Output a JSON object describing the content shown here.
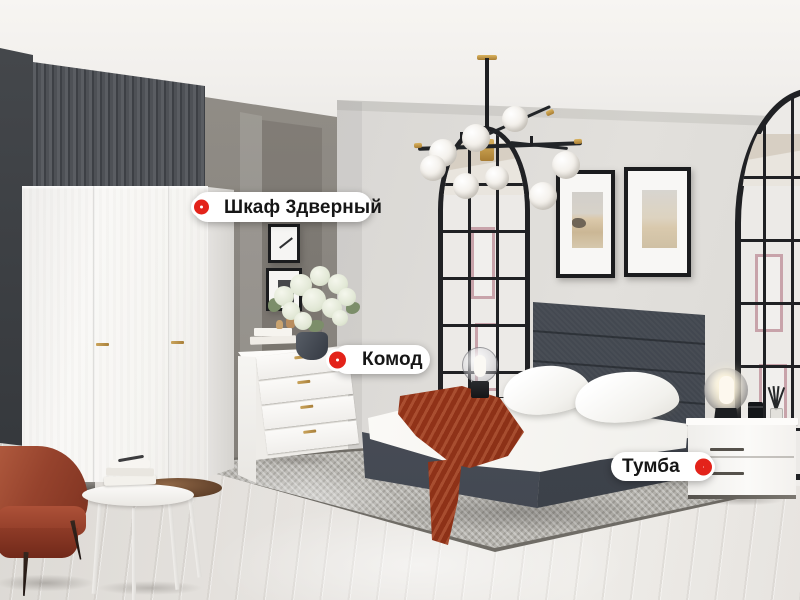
{
  "hotspots": [
    {
      "id": "wardrobe",
      "label": "Шкаф 3дверный",
      "marker": "red-ring-icon",
      "marker_side": "left"
    },
    {
      "id": "dresser",
      "label": "Комод",
      "marker": "red-ring-icon",
      "marker_side": "left"
    },
    {
      "id": "nightstand",
      "label": "Тумба",
      "marker": "red-ring-icon",
      "marker_side": "right"
    }
  ],
  "colors": {
    "marker_red": "#e3231a",
    "label_background": "#ffffff",
    "label_text": "#161616",
    "accent_gold": "#c49a4e",
    "wall_dark": "#3f4246",
    "wall_taupe": "#8d8984",
    "wall_light": "#d9d6d3",
    "headboard_grey": "#474c54",
    "throw_rust": "#96351a",
    "armchair_rust": "#96432d",
    "rug_grey": "#b7b5b0",
    "floor_wood": "#e3e0dc"
  }
}
